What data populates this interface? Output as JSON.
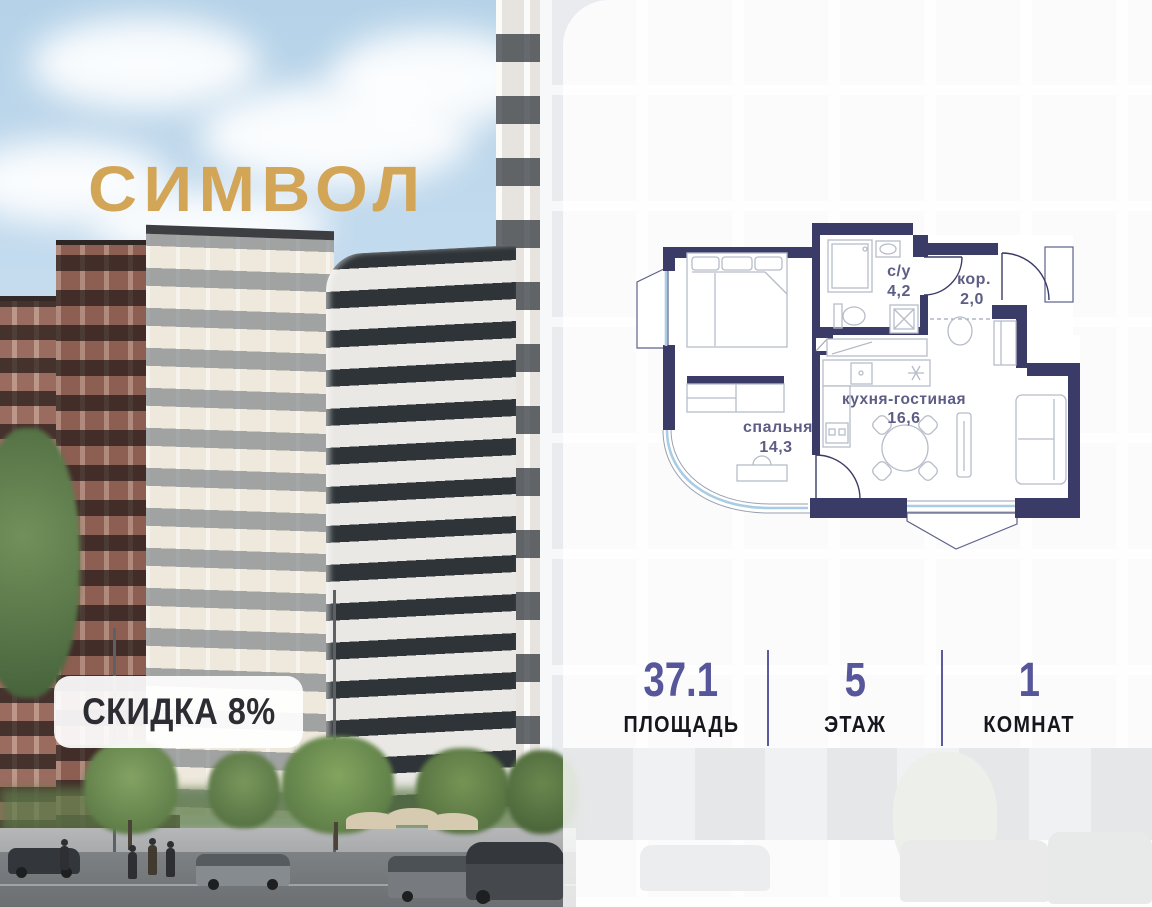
{
  "project": {
    "logo_text": "СИМВОЛ",
    "discount_badge": "СКИДКА 8%"
  },
  "floor_plan": {
    "rooms": [
      {
        "id": "bathroom",
        "label": "с/у",
        "area": "4,2"
      },
      {
        "id": "corridor",
        "label": "кор.",
        "area": "2,0"
      },
      {
        "id": "kitchen_living",
        "label": "кухня-гостиная",
        "area": "16,6"
      },
      {
        "id": "bedroom",
        "label": "спальня",
        "area": "14,3"
      }
    ]
  },
  "stats": [
    {
      "value": "37.1",
      "label": "ПЛОЩАДЬ"
    },
    {
      "value": "5",
      "label": "ЭТАЖ"
    },
    {
      "value": "1",
      "label": "КОМНАТ"
    }
  ],
  "colors": {
    "logo_gold": "#d2a557",
    "plan_wall": "#3b3b68",
    "plan_label": "#5d5d85",
    "plan_window": "#a9cde4",
    "stat_number": "#57569b",
    "stat_label": "#16161c",
    "divider": "#5a5a9c",
    "badge_bg": "#ffffff",
    "badge_text": "#2c2c32",
    "sky_top": "#b5d2e8"
  }
}
